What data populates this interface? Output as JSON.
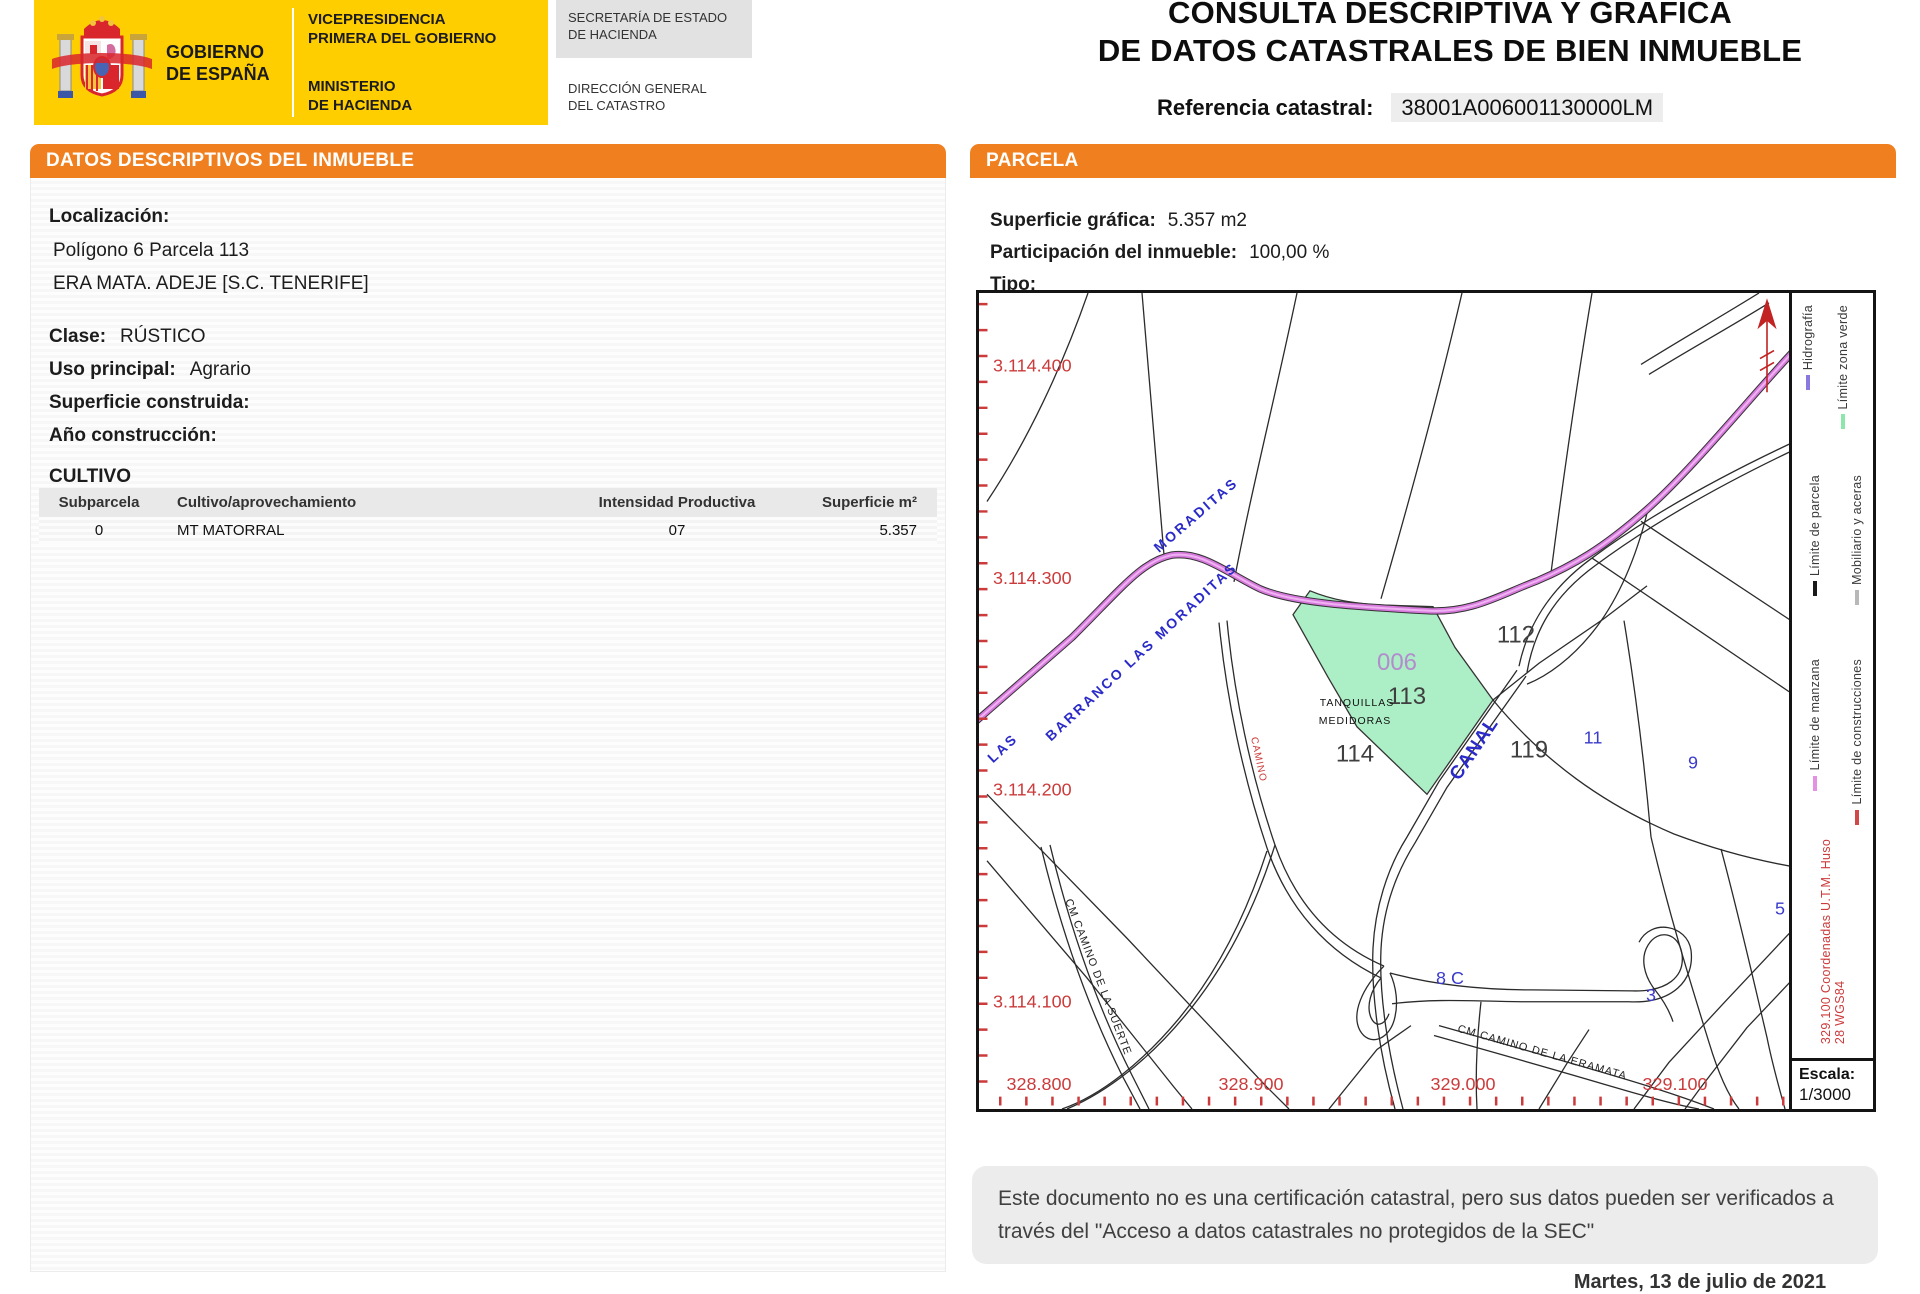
{
  "header": {
    "gobierno": [
      "GOBIERNO",
      "DE ESPAÑA"
    ],
    "vicepresidencia": [
      "VICEPRESIDENCIA",
      "PRIMERA DEL GOBIERNO"
    ],
    "ministerio": [
      "MINISTERIO",
      "DE HACIENDA"
    ],
    "secretaria": [
      "SECRETARÍA DE ESTADO",
      "DE HACIENDA"
    ],
    "direccion": [
      "DIRECCIÓN GENERAL",
      "DEL CATASTRO"
    ],
    "title_line1": "CONSULTA DESCRIPTIVA Y GRÁFICA",
    "title_line2": "DE DATOS CATASTRALES DE BIEN INMUEBLE",
    "referencia_label": "Referencia catastral:",
    "referencia_value": "38001A006001130000LM"
  },
  "left_panel": {
    "title": "DATOS DESCRIPTIVOS DEL INMUEBLE",
    "localizacion_label": "Localización:",
    "localizacion_line1": "Polígono 6 Parcela 113",
    "localizacion_line2": "ERA MATA. ADEJE [S.C. TENERIFE]",
    "clase_label": "Clase:",
    "clase_value": "RÚSTICO",
    "uso_label": "Uso principal:",
    "uso_value": "Agrario",
    "superficie_label": "Superficie construida:",
    "superficie_value": "",
    "anio_label": "Año construcción:",
    "anio_value": "",
    "cultivo": {
      "title": "CULTIVO",
      "columns": [
        "Subparcela",
        "Cultivo/aprovechamiento",
        "Intensidad Productiva",
        "Superficie m²"
      ],
      "rows": [
        [
          "0",
          "MT MATORRAL",
          "07",
          "5.357"
        ]
      ]
    }
  },
  "right_panel": {
    "title": "PARCELA",
    "superficie_grafica_label": "Superficie gráfica:",
    "superficie_grafica_value": "5.357 m2",
    "participacion_label": "Participación del inmueble:",
    "participacion_value": "100,00 %",
    "tipo_label": "Tipo:",
    "tipo_value": "",
    "map": {
      "y_axis": [
        "3.114.400",
        "3.114.300",
        "3.114.200",
        "3.114.100"
      ],
      "x_axis": [
        "328.800",
        "328.900",
        "329.000",
        "329.100"
      ],
      "parcels": [
        "112",
        "113",
        "114",
        "119"
      ],
      "subparcela": "006",
      "blue_labels": [
        "11",
        "9",
        "5",
        "3",
        "8 C"
      ],
      "site_line1": "TANQUILLAS",
      "site_line2": "MEDIDORAS",
      "canal": "CANAL",
      "barranco_run": "BARRANCO  LAS  MORADITAS",
      "moraditas": "MORADITAS",
      "las": "LAS",
      "camino_red": "CAMINO",
      "camino_suerte": "CM CAMINO DE LA SUERTE",
      "camino_eramata": "CM CAMINO DE LA ERAMATA",
      "legend": [
        {
          "label": "Hidrografía",
          "color": "#8a7ae0"
        },
        {
          "label": "Límite zona verde",
          "color": "#8fe6ac"
        },
        {
          "label": "Límite de parcela",
          "color": "#1a1a1a"
        },
        {
          "label": "Mobiliario y aceras",
          "color": "#b8b8b8"
        },
        {
          "label": "Límite de manzana",
          "color": "#e490e4"
        },
        {
          "label": "Límite de construcciones",
          "color": "#d04848"
        }
      ],
      "utm_note": "329.100 Coordenadas U.T.M. Huso 28 WGS84",
      "escala_label": "Escala:",
      "escala_value": "1/3000"
    }
  },
  "footer": {
    "disclaimer_line1": "Este documento no es una certificación catastral, pero sus datos pueden ser verificados a",
    "disclaimer_line2": "través del \"Acceso a datos catastrales no protegidos de la SEC\"",
    "date": "Martes, 13 de julio de 2021"
  },
  "colors": {
    "accent_orange": "#f0801f",
    "logo_yellow": "#ffce00",
    "map_green": "#aceec6",
    "barranco_pink": "#d678dc",
    "coord_red": "#cc3b3b",
    "label_blue": "#3a3acc",
    "subparcel_purple": "#b28ccc"
  }
}
